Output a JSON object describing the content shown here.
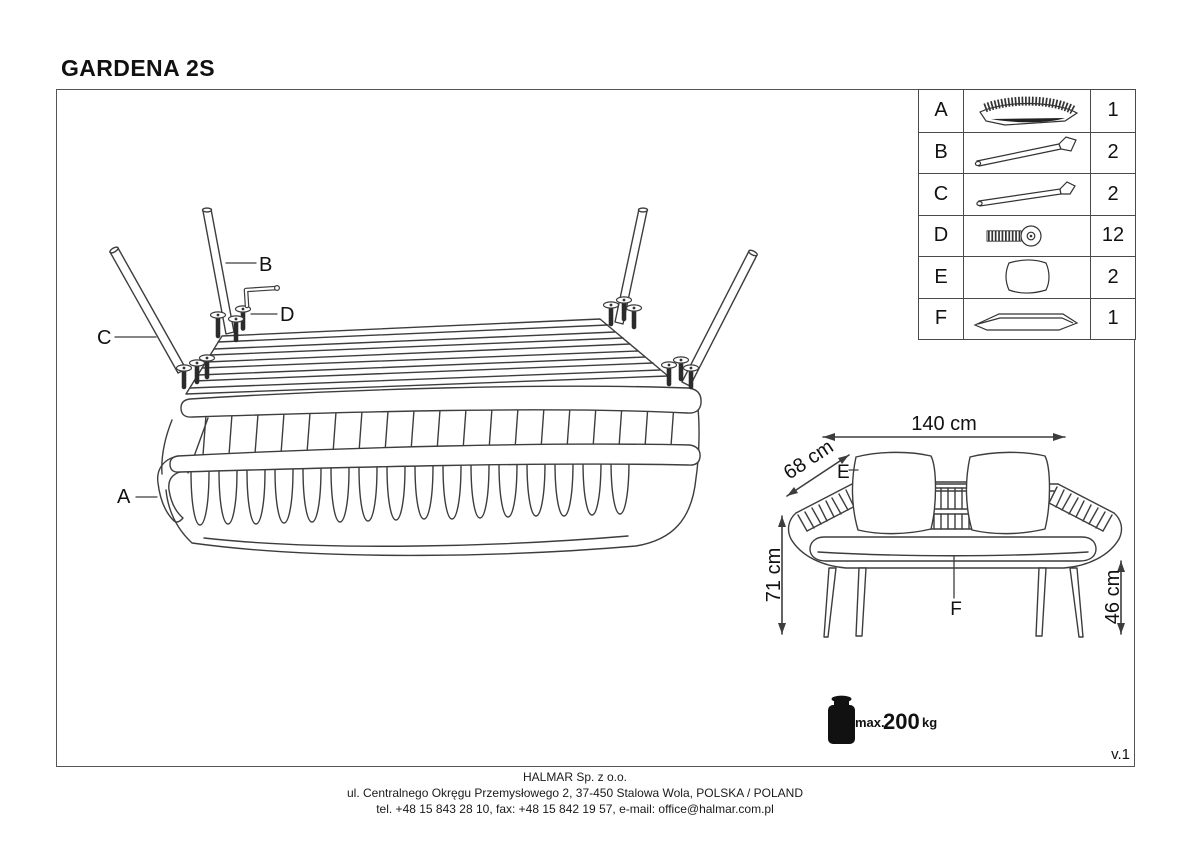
{
  "title": "GARDENA 2S",
  "version": "v.1",
  "parts_table": {
    "rows": [
      {
        "id": "A",
        "part": "sofa-body",
        "qty": "1"
      },
      {
        "id": "B",
        "part": "rear-leg-tube",
        "qty": "2"
      },
      {
        "id": "C",
        "part": "front-leg-tube",
        "qty": "2"
      },
      {
        "id": "D",
        "part": "allen-bolt",
        "qty": "12"
      },
      {
        "id": "E",
        "part": "pillow",
        "qty": "2"
      },
      {
        "id": "F",
        "part": "seat-cushion",
        "qty": "1"
      }
    ]
  },
  "assembly": {
    "label_a": "A",
    "label_b": "B",
    "label_c": "C",
    "label_d": "D"
  },
  "dimensions": {
    "width": "140 cm",
    "depth": "68 cm",
    "height": "71 cm",
    "seat_height": "46 cm",
    "label_e": "E",
    "label_f": "F"
  },
  "max_load": {
    "prefix": "max.",
    "value": "200",
    "unit": "kg"
  },
  "footer": {
    "company": "HALMAR Sp. z o.o.",
    "address": "ul. Centralnego Okręgu Przemysłowego 2, 37-450 Stalowa Wola, POLSKA / POLAND",
    "contact": "tel. +48 15 843 28 10, fax: +48 15 842 19 57, e-mail: office@halmar.com.pl"
  },
  "colors": {
    "line": "#3d3d3d",
    "text": "#111111",
    "border": "#555555"
  }
}
